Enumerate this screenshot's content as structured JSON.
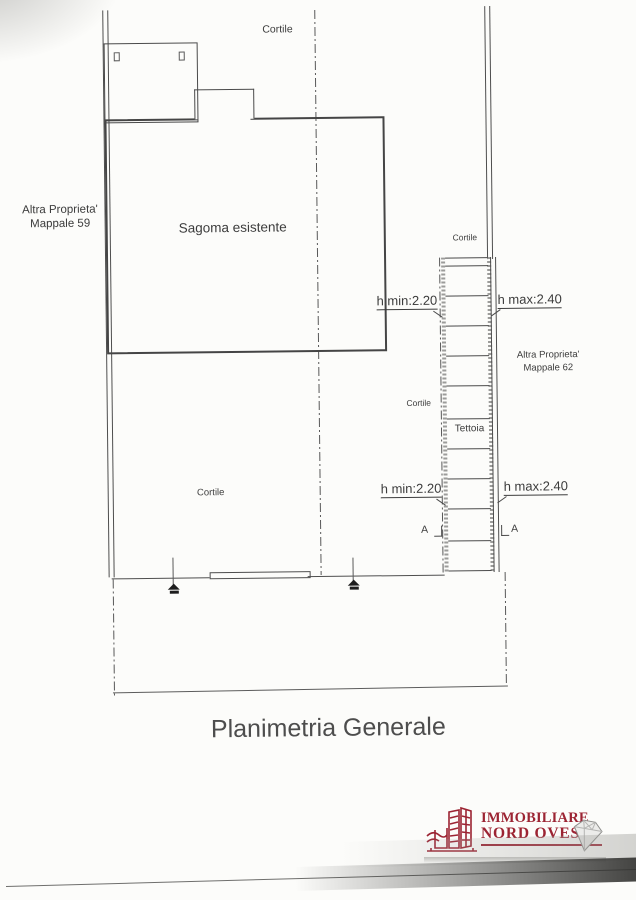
{
  "page": {
    "title": "Planimetria Generale"
  },
  "plan": {
    "labels": {
      "cortile_top": "Cortile",
      "cortile_right": "Cortile",
      "cortile_middle": "Cortile",
      "cortile_left": "Cortile",
      "sagoma": "Sagoma esistente",
      "tettoia": "Tettoia",
      "altra_59_line1": "Altra Proprieta'",
      "altra_59_line2": "Mappale 59",
      "altra_62_line1": "Altra Proprieta'",
      "altra_62_line2": "Mappale 62",
      "h_min_upper": "h min:2.20",
      "h_max_upper": "h max:2.40",
      "h_min_lower": "h min:2.20",
      "h_max_lower": "h max:2.40",
      "section_marker_left": "A",
      "section_marker_right": "A"
    }
  },
  "logo": {
    "line1": "IMMOBILIARE",
    "line2": "NORD OVEST"
  },
  "colors": {
    "ink": "#4a4a4a",
    "paper": "#fcfcfa",
    "logo_red": "#9c2433"
  }
}
